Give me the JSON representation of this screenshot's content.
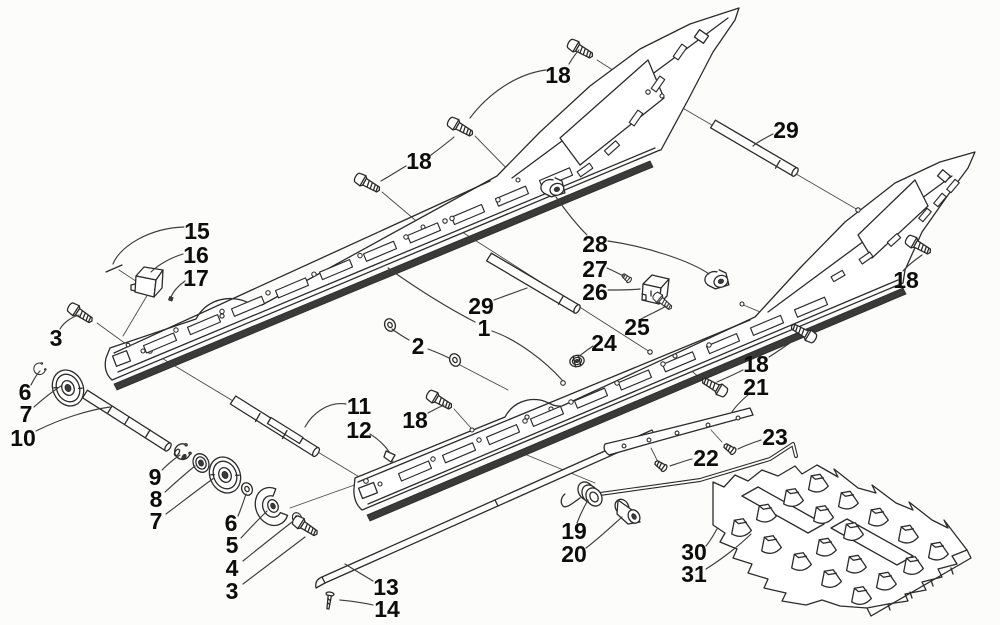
{
  "colors": {
    "background": "#fcfdfa",
    "line": "#2b2b2b",
    "dark_fill": "#3a3a3a"
  },
  "callouts": [
    {
      "label": "18"
    },
    {
      "label": "29"
    },
    {
      "label": "18"
    },
    {
      "label": "15"
    },
    {
      "label": "16"
    },
    {
      "label": "17"
    },
    {
      "label": "28"
    },
    {
      "label": "27"
    },
    {
      "label": "26"
    },
    {
      "label": "25"
    },
    {
      "label": "24"
    },
    {
      "label": "18"
    },
    {
      "label": "29"
    },
    {
      "label": "1"
    },
    {
      "label": "2"
    },
    {
      "label": "3"
    },
    {
      "label": "6"
    },
    {
      "label": "7"
    },
    {
      "label": "10"
    },
    {
      "label": "11"
    },
    {
      "label": "12"
    },
    {
      "label": "18"
    },
    {
      "label": "18"
    },
    {
      "label": "21"
    },
    {
      "label": "23"
    },
    {
      "label": "22"
    },
    {
      "label": "9"
    },
    {
      "label": "8"
    },
    {
      "label": "7"
    },
    {
      "label": "6"
    },
    {
      "label": "5"
    },
    {
      "label": "4"
    },
    {
      "label": "3"
    },
    {
      "label": "13"
    },
    {
      "label": "14"
    },
    {
      "label": "19"
    },
    {
      "label": "20"
    },
    {
      "label": "30"
    },
    {
      "label": "31"
    }
  ]
}
